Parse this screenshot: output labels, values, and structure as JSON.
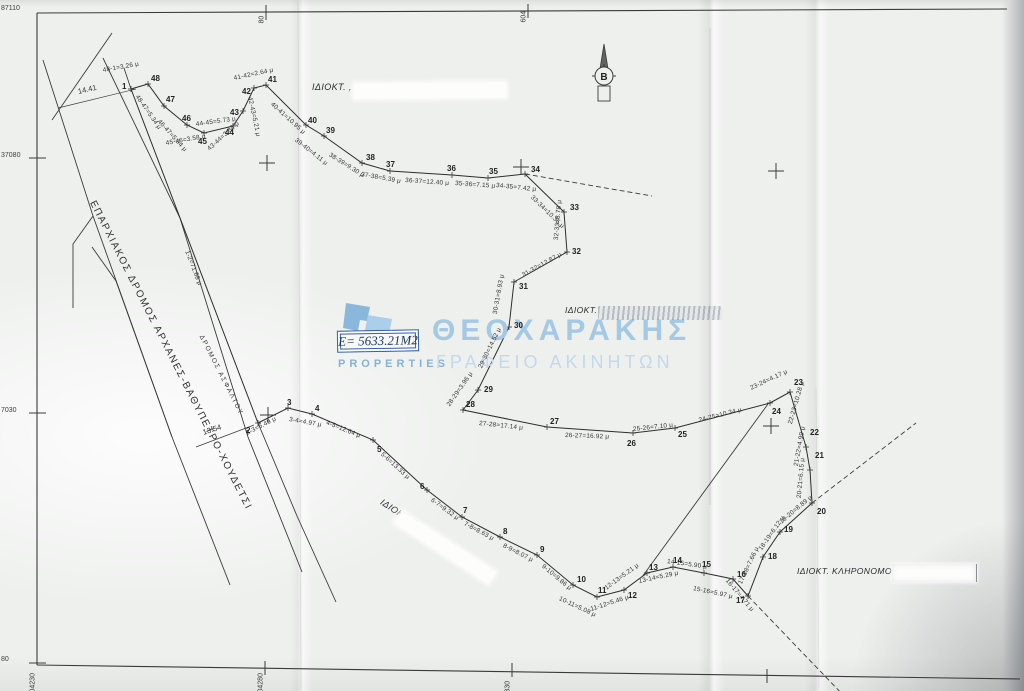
{
  "watermark": {
    "brand": "ΘΕΟΧΑΡΑΚΗΣ",
    "subtitle": "ΓΡΑΦΕΙΟ ΑΚΙΝΗΤΩΝ",
    "logo_text": "PROPERTIES",
    "brand_color": "#a4c9e5",
    "subtitle_color": "#c3d9ec"
  },
  "area": {
    "label": "Ε= 5633.21Μ2"
  },
  "north": {
    "label": "Β"
  },
  "owners": {
    "top": "ΙΔΙΟΚΤ. ,",
    "middle": "ΙΔΙΟΚΤ.",
    "south": "ΙΔΙΟΚΤ. Γ",
    "southeast": "ΙΔΙΟΚΤ. ΚΛΗΡΟΝΟΜΟΙ Γ"
  },
  "roads": {
    "main": "ΕΠΑΡΧΙΑΚΟΣ ΔΡΟΜΟΣ ΑΡΧΑΝΕΣ-ΒΑΘΥΠΕΤΡΟ-ΧΟΥΔΕΤΣΙ",
    "asphalt_edge": "ΔΡΟΜΟΣ ΑΣΦΑΛΤΟΥ"
  },
  "grid": {
    "labels": [
      {
        "t": "87110",
        "x": 1,
        "y": 5,
        "r": 0
      },
      {
        "t": "37080",
        "x": 1,
        "y": 152,
        "r": 0
      },
      {
        "t": "7030",
        "x": 1,
        "y": 407,
        "r": 0
      },
      {
        "t": "80",
        "x": 1,
        "y": 656,
        "r": 0
      },
      {
        "t": "80",
        "x": 262,
        "y": 20,
        "r": -90
      },
      {
        "t": "604",
        "x": 524,
        "y": 19,
        "r": -90
      },
      {
        "t": "04230",
        "x": 33,
        "y": 689,
        "r": -90
      },
      {
        "t": "04280",
        "x": 261,
        "y": 689,
        "r": -90
      },
      {
        "t": "330",
        "x": 508,
        "y": 689,
        "r": -90
      }
    ]
  },
  "survey": {
    "outline": [
      {
        "n": 1,
        "x": 131,
        "y": 89,
        "lx": 122,
        "ly": 83
      },
      {
        "n": 2,
        "x": 258,
        "y": 423,
        "lx": 246,
        "ly": 427
      },
      {
        "n": 3,
        "x": 288,
        "y": 408,
        "lx": 287,
        "ly": 399
      },
      {
        "n": 4,
        "x": 312,
        "y": 414,
        "lx": 315,
        "ly": 405
      },
      {
        "n": 5,
        "x": 373,
        "y": 440,
        "lx": 377,
        "ly": 446
      },
      {
        "n": 6,
        "x": 427,
        "y": 490,
        "lx": 420,
        "ly": 483
      },
      {
        "n": 7,
        "x": 462,
        "y": 517,
        "lx": 463,
        "ly": 507
      },
      {
        "n": 8,
        "x": 500,
        "y": 537,
        "lx": 503,
        "ly": 528
      },
      {
        "n": 9,
        "x": 537,
        "y": 555,
        "lx": 540,
        "ly": 546
      },
      {
        "n": 10,
        "x": 573,
        "y": 585,
        "lx": 577,
        "ly": 576
      },
      {
        "n": 11,
        "x": 597,
        "y": 597,
        "lx": 598,
        "ly": 587
      },
      {
        "n": 12,
        "x": 624,
        "y": 590,
        "lx": 628,
        "ly": 592
      },
      {
        "n": 13,
        "x": 647,
        "y": 573,
        "lx": 649,
        "ly": 564
      },
      {
        "n": 14,
        "x": 673,
        "y": 567,
        "lx": 673,
        "ly": 557
      },
      {
        "n": 15,
        "x": 704,
        "y": 573,
        "lx": 702,
        "ly": 561
      },
      {
        "n": 16,
        "x": 733,
        "y": 579,
        "lx": 737,
        "ly": 571
      },
      {
        "n": 17,
        "x": 748,
        "y": 596,
        "lx": 736,
        "ly": 597
      },
      {
        "n": 18,
        "x": 763,
        "y": 557,
        "lx": 768,
        "ly": 553
      },
      {
        "n": 19,
        "x": 780,
        "y": 532,
        "lx": 784,
        "ly": 526
      },
      {
        "n": 20,
        "x": 812,
        "y": 503,
        "lx": 817,
        "ly": 508
      },
      {
        "n": 21,
        "x": 810,
        "y": 470,
        "lx": 815,
        "ly": 452
      },
      {
        "n": 22,
        "x": 806,
        "y": 447,
        "lx": 810,
        "ly": 429
      },
      {
        "n": 23,
        "x": 790,
        "y": 392,
        "lx": 794,
        "ly": 379
      },
      {
        "n": 24,
        "x": 770,
        "y": 403,
        "lx": 772,
        "ly": 408
      },
      {
        "n": 25,
        "x": 675,
        "y": 428,
        "lx": 678,
        "ly": 431
      },
      {
        "n": 26,
        "x": 633,
        "y": 433,
        "lx": 627,
        "ly": 440
      },
      {
        "n": 27,
        "x": 547,
        "y": 427,
        "lx": 550,
        "ly": 418
      },
      {
        "n": 28,
        "x": 463,
        "y": 410,
        "lx": 466,
        "ly": 401
      },
      {
        "n": 29,
        "x": 478,
        "y": 390,
        "lx": 484,
        "ly": 386
      },
      {
        "n": 30,
        "x": 509,
        "y": 327,
        "lx": 514,
        "ly": 322
      },
      {
        "n": 31,
        "x": 514,
        "y": 282,
        "lx": 519,
        "ly": 283
      },
      {
        "n": 32,
        "x": 567,
        "y": 252,
        "lx": 572,
        "ly": 248
      },
      {
        "n": 33,
        "x": 564,
        "y": 212,
        "lx": 570,
        "ly": 204
      },
      {
        "n": 34,
        "x": 525,
        "y": 174,
        "lx": 531,
        "ly": 166
      },
      {
        "n": 35,
        "x": 488,
        "y": 178,
        "lx": 489,
        "ly": 168
      },
      {
        "n": 36,
        "x": 452,
        "y": 175,
        "lx": 447,
        "ly": 165
      },
      {
        "n": 37,
        "x": 390,
        "y": 171,
        "lx": 386,
        "ly": 161
      },
      {
        "n": 38,
        "x": 362,
        "y": 163,
        "lx": 366,
        "ly": 154
      },
      {
        "n": 39,
        "x": 324,
        "y": 136,
        "lx": 326,
        "ly": 127
      },
      {
        "n": 40,
        "x": 306,
        "y": 125,
        "lx": 308,
        "ly": 117
      },
      {
        "n": 41,
        "x": 266,
        "y": 85,
        "lx": 268,
        "ly": 76
      },
      {
        "n": 42,
        "x": 254,
        "y": 88,
        "lx": 242,
        "ly": 88
      },
      {
        "n": 43,
        "x": 243,
        "y": 111,
        "lx": 230,
        "ly": 109
      },
      {
        "n": 44,
        "x": 233,
        "y": 126,
        "lx": 225,
        "ly": 129
      },
      {
        "n": 45,
        "x": 204,
        "y": 133,
        "lx": 198,
        "ly": 138
      },
      {
        "n": 46,
        "x": 187,
        "y": 125,
        "lx": 182,
        "ly": 115
      },
      {
        "n": 47,
        "x": 164,
        "y": 106,
        "lx": 166,
        "ly": 96
      },
      {
        "n": 48,
        "x": 148,
        "y": 84,
        "lx": 151,
        "ly": 75
      }
    ],
    "distance_labels": [
      {
        "t": "48-1=3.26 μ",
        "x": 103,
        "y": 68,
        "r": -10
      },
      {
        "t": "14.41",
        "x": 78,
        "y": 88,
        "r": -13,
        "cls": "dim"
      },
      {
        "t": "48-47=5.34 μ",
        "x": 136,
        "y": 93,
        "r": 55
      },
      {
        "t": "46-47=5.94 μ",
        "x": 158,
        "y": 118,
        "r": 48
      },
      {
        "t": "45-46=3.58 μ",
        "x": 166,
        "y": 141,
        "r": -10
      },
      {
        "t": "44-45=5.73 μ",
        "x": 196,
        "y": 122,
        "r": -8
      },
      {
        "t": "43-44=3.34 μ",
        "x": 209,
        "y": 147,
        "r": -42
      },
      {
        "t": "42-43=5.21 μ",
        "x": 249,
        "y": 94,
        "r": 78
      },
      {
        "t": "41-42=2.64 μ",
        "x": 234,
        "y": 76,
        "r": -12
      },
      {
        "t": "40-41=10.95 μ",
        "x": 271,
        "y": 101,
        "r": 42
      },
      {
        "t": "39-40=4.11 μ",
        "x": 295,
        "y": 137,
        "r": 38
      },
      {
        "t": "38-39=9.30 μ",
        "x": 329,
        "y": 152,
        "r": 32
      },
      {
        "t": "37-38=5.39 μ",
        "x": 361,
        "y": 172,
        "r": 10
      },
      {
        "t": "36-37=12.40 μ",
        "x": 405,
        "y": 178,
        "r": 4
      },
      {
        "t": "35-36=7.15 μ",
        "x": 455,
        "y": 181,
        "r": 4
      },
      {
        "t": "34-35=7.42 μ",
        "x": 496,
        "y": 183,
        "r": 6
      },
      {
        "t": "33-34=10.35 μ",
        "x": 531,
        "y": 194,
        "r": 44
      },
      {
        "t": "32-33=8.78 μ",
        "x": 557,
        "y": 237,
        "r": -85
      },
      {
        "t": "31-32=12.87 μ",
        "x": 523,
        "y": 273,
        "r": -29
      },
      {
        "t": "30-31=8.93 μ",
        "x": 496,
        "y": 311,
        "r": -80
      },
      {
        "t": "29-30=14.52 μ",
        "x": 481,
        "y": 365,
        "r": -64
      },
      {
        "t": "28-29=3.96 μ",
        "x": 449,
        "y": 403,
        "r": -55
      },
      {
        "t": "27-28=17.14 μ",
        "x": 479,
        "y": 421,
        "r": 6
      },
      {
        "t": "26-27=16.92 μ",
        "x": 565,
        "y": 433,
        "r": 2
      },
      {
        "t": "25-26=7.10 μ",
        "x": 633,
        "y": 427,
        "r": -6
      },
      {
        "t": "24-25=10.34 μ",
        "x": 699,
        "y": 418,
        "r": -14
      },
      {
        "t": "23-24=4.17 μ",
        "x": 751,
        "y": 386,
        "r": -25
      },
      {
        "t": "22-23=10.28 μ",
        "x": 791,
        "y": 421,
        "r": -74
      },
      {
        "t": "21-22=4.99 μ",
        "x": 797,
        "y": 463,
        "r": -80
      },
      {
        "t": "20-21=6.15 μ",
        "x": 800,
        "y": 495,
        "r": -85
      },
      {
        "t": "19-20=8.89 μ",
        "x": 781,
        "y": 520,
        "r": -40
      },
      {
        "t": "18-19=6.12 μ",
        "x": 761,
        "y": 547,
        "r": -55
      },
      {
        "t": "17-18=7.66 μ",
        "x": 741,
        "y": 581,
        "r": -65
      },
      {
        "t": "16-17=4.71 μ",
        "x": 726,
        "y": 577,
        "r": 50
      },
      {
        "t": "15-16=5.97 μ",
        "x": 693,
        "y": 586,
        "r": 12
      },
      {
        "t": "14-15=5.90 μ",
        "x": 667,
        "y": 559,
        "r": 8
      },
      {
        "t": "13-14=5.29 μ",
        "x": 639,
        "y": 579,
        "r": -12
      },
      {
        "t": "12-13=5.21 μ",
        "x": 606,
        "y": 586,
        "r": -36
      },
      {
        "t": "11-12=5.46 μ",
        "x": 591,
        "y": 607,
        "r": -18
      },
      {
        "t": "10-11=5.08 μ",
        "x": 559,
        "y": 596,
        "r": 25
      },
      {
        "t": "9-10=9.86 μ",
        "x": 542,
        "y": 563,
        "r": 40
      },
      {
        "t": "8-9=8.07 μ",
        "x": 503,
        "y": 543,
        "r": 27
      },
      {
        "t": "7-8=8.63 μ",
        "x": 464,
        "y": 521,
        "r": 28
      },
      {
        "t": "6-7=9.32 μ",
        "x": 431,
        "y": 497,
        "r": 36
      },
      {
        "t": "5-6=13.33 μ",
        "x": 381,
        "y": 451,
        "r": 42
      },
      {
        "t": "4-5=12.64 μ",
        "x": 326,
        "y": 420,
        "r": 22
      },
      {
        "t": "3-4=4.97 μ",
        "x": 289,
        "y": 417,
        "r": 10
      },
      {
        "t": "2-3=6.49 μ",
        "x": 247,
        "y": 431,
        "r": -27
      },
      {
        "t": "1-2=71.68 μ",
        "x": 186,
        "y": 248,
        "r": 69
      },
      {
        "t": "13.54",
        "x": 203,
        "y": 429,
        "r": -18,
        "cls": "dim"
      }
    ]
  },
  "map": {
    "crosses": [
      [
        267,
        163
      ],
      [
        521,
        167
      ],
      [
        776,
        171
      ],
      [
        268,
        415
      ],
      [
        771,
        426
      ]
    ],
    "lines": [
      {
        "pts": [
          [
            37,
            13
          ],
          [
            1007,
            9
          ]
        ],
        "w": 1.1,
        "name": "frame-top"
      },
      {
        "pts": [
          [
            37,
            13
          ],
          [
            37,
            665
          ]
        ],
        "w": 1.1,
        "name": "frame-left"
      },
      {
        "pts": [
          [
            37,
            665
          ],
          [
            1020,
            679
          ]
        ],
        "w": 1.1,
        "name": "frame-bottom"
      },
      {
        "pts": [
          [
            29,
            158
          ],
          [
            46,
            158
          ]
        ],
        "w": 1,
        "name": "grid-tick"
      },
      {
        "pts": [
          [
            29,
            413
          ],
          [
            46,
            413
          ]
        ],
        "w": 1,
        "name": "grid-tick"
      },
      {
        "pts": [
          [
            29,
            663
          ],
          [
            46,
            663
          ]
        ],
        "w": 1,
        "name": "grid-tick"
      },
      {
        "pts": [
          [
            266,
            5
          ],
          [
            266,
            20
          ]
        ],
        "w": 1,
        "name": "grid-tick"
      },
      {
        "pts": [
          [
            528,
            4
          ],
          [
            528,
            18
          ]
        ],
        "w": 1,
        "name": "grid-tick"
      },
      {
        "pts": [
          [
            265,
            661
          ],
          [
            265,
            675
          ]
        ],
        "w": 1,
        "name": "grid-tick"
      },
      {
        "pts": [
          [
            512,
            663
          ],
          [
            512,
            677
          ]
        ],
        "w": 1,
        "name": "grid-tick"
      },
      {
        "pts": [
          [
            767,
            669
          ],
          [
            767,
            683
          ]
        ],
        "w": 1,
        "name": "grid-tick"
      },
      {
        "pts": [
          [
            112,
            33
          ],
          [
            52,
            120
          ]
        ],
        "name": "road-line"
      },
      {
        "pts": [
          [
            43,
            60
          ],
          [
            93,
            216
          ],
          [
            73,
            244
          ],
          [
            73,
            308
          ]
        ],
        "name": "road-line"
      },
      {
        "pts": [
          [
            93,
            216
          ],
          [
            172,
            437
          ],
          [
            230,
            585
          ]
        ],
        "name": "road-line"
      },
      {
        "pts": [
          [
            92,
            247
          ],
          [
            116,
            281
          ],
          [
            172,
            437
          ]
        ],
        "name": "road-line"
      },
      {
        "pts": [
          [
            103,
            58
          ],
          [
            180,
            218
          ],
          [
            248,
            437
          ],
          [
            302,
            572
          ]
        ],
        "name": "road-axis"
      },
      {
        "pts": [
          [
            124,
            68
          ],
          [
            131,
            89
          ]
        ],
        "name": "road-edge-line"
      },
      {
        "pts": [
          [
            258,
            423
          ],
          [
            297,
            516
          ],
          [
            336,
            602
          ]
        ],
        "name": "road-edge-line"
      },
      {
        "pts": [
          [
            58,
            108
          ],
          [
            136,
            89
          ]
        ],
        "w": 0.7,
        "name": "dimension-line"
      },
      {
        "pts": [
          [
            196,
            447
          ],
          [
            254,
            425
          ]
        ],
        "w": 0.7,
        "name": "dimension-line"
      },
      {
        "pts": [
          [
            525,
            174
          ],
          [
            652,
            196
          ]
        ],
        "dash": "5 3",
        "name": "dashed-extension"
      },
      {
        "pts": [
          [
            768,
            404
          ],
          [
            642,
            577
          ]
        ],
        "name": "division-line"
      },
      {
        "pts": [
          [
            812,
            503
          ],
          [
            916,
            423
          ]
        ],
        "dash": "5 3",
        "name": "dashed-extension"
      },
      {
        "pts": [
          [
            748,
            596
          ],
          [
            846,
            698
          ]
        ],
        "dash": "5 3",
        "name": "dashed-extension"
      },
      {
        "pts": [
          [
            710,
            28
          ],
          [
            710,
            505
          ]
        ],
        "stroke": "rgba(60,60,60,0.25)",
        "w": 0.6,
        "name": "paper-crease"
      },
      {
        "pts": [
          [
            298,
            2
          ],
          [
            301,
            689
          ]
        ],
        "stroke": "rgba(120,120,120,0.18)",
        "w": 0.8,
        "name": "paper-crease"
      },
      {
        "pts": [
          [
            816,
            388
          ],
          [
            819,
            689
          ]
        ],
        "stroke": "rgba(120,120,120,0.15)",
        "w": 0.8,
        "name": "paper-crease"
      }
    ]
  }
}
